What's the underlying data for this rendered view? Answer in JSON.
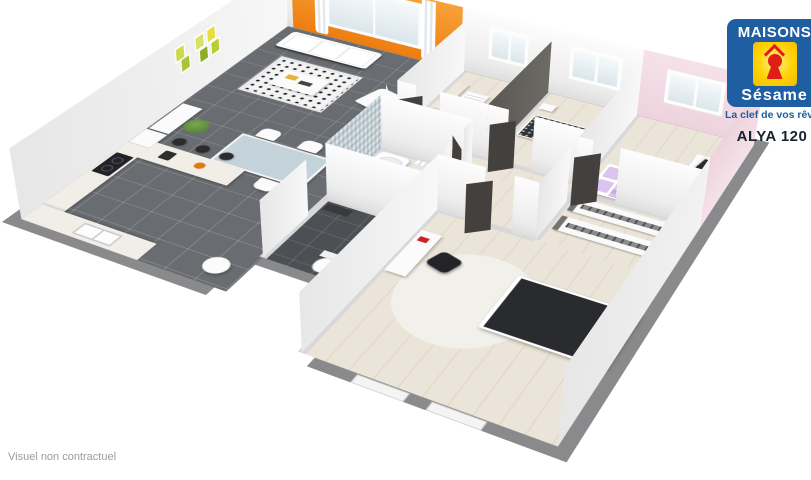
{
  "branding": {
    "logo_line1": "MAISONS",
    "logo_line2": "Sésame",
    "tagline": "La clef de vos rêves",
    "colors": {
      "blue": "#1e5ea1",
      "yellow": "#ffd203",
      "red": "#dd1f16"
    }
  },
  "model_name": "ALYA 120",
  "disclaimer": "Visuel non contractuel",
  "floorplan": {
    "style": "3d-isometric-cutaway-house",
    "palette": {
      "exterior_wall_top": "#8a8a8c",
      "living_floor_tile": "#696c70",
      "wc_floor_tile": "#4c4f53",
      "bedroom_floor": "#ebe4d8",
      "bathroom_floor": "#e9e6e0",
      "accent_wall_orange": "#ee7d10",
      "accent_wall_pink": "#f2d9e2",
      "bed_purple": "#b97fd6",
      "duvet_dark": "#2a2b2f"
    },
    "rooms": [
      {
        "name": "living-dining-room",
        "floor": "dark-gray-tile",
        "furniture": [
          "white-sofa",
          "patterned-rug",
          "coffee-table",
          "lounge-chair",
          "glass-dining-table",
          "four-white-chairs",
          "sideboard",
          "plant",
          "botanical-wall-art",
          "orange-accent-wall-with-window"
        ]
      },
      {
        "name": "open-kitchen",
        "floor": "dark-gray-tile",
        "furniture": [
          "l-shaped-counter",
          "bar-peninsula",
          "three-bar-stools",
          "cooktop",
          "double-sink",
          "fridge",
          "white-pouf"
        ]
      },
      {
        "name": "wc",
        "floor": "dark-tile",
        "furniture": [
          "toilet",
          "dark-shelf"
        ]
      },
      {
        "name": "nursery-bedroom",
        "floor": "beige",
        "furniture": [
          "crib",
          "bookshelf",
          "changing-dresser",
          "window"
        ]
      },
      {
        "name": "bedroom-2",
        "floor": "beige",
        "furniture": [
          "bed-patterned-duvet",
          "nightstand",
          "window",
          "slippers"
        ]
      },
      {
        "name": "bedroom-3-pink",
        "floor": "beige",
        "furniture": [
          "purple-bed",
          "desk",
          "chalkboard",
          "window"
        ]
      },
      {
        "name": "bathroom",
        "floor": "light-tile",
        "furniture": [
          "bathtub",
          "mosaic-tiled-wall",
          "vanity",
          "towel-radiator"
        ]
      },
      {
        "name": "hallway",
        "floor": "beige",
        "furniture": [
          "open-dark-doors"
        ]
      },
      {
        "name": "dressing",
        "floor": "beige",
        "furniture": [
          "wardrobe-shelves-with-hangers"
        ]
      },
      {
        "name": "master-bedroom",
        "floor": "beige",
        "furniture": [
          "dark-bed-white-pillows",
          "white-rug",
          "desk",
          "black-office-chair",
          "nightstand",
          "two-windows"
        ]
      }
    ]
  }
}
